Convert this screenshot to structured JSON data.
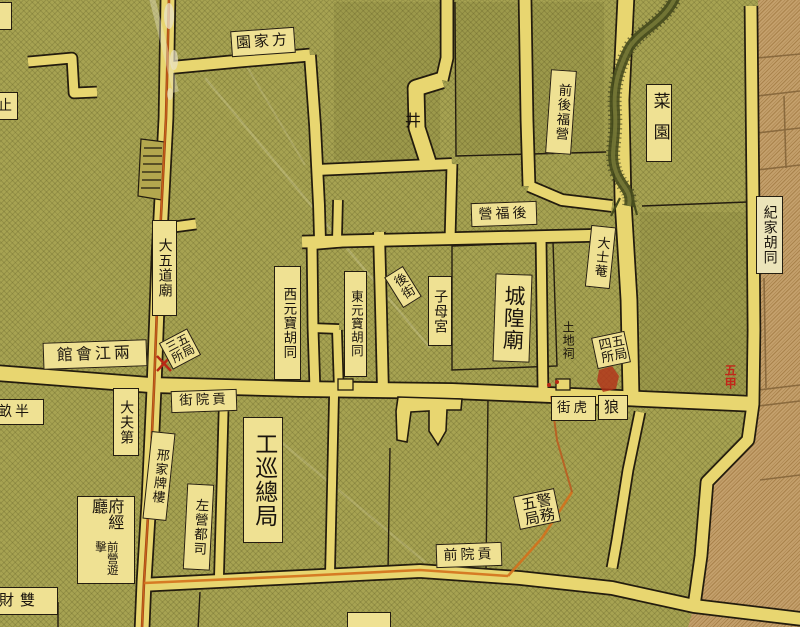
{
  "map": {
    "kind": "historical-chinese-city-map",
    "colors": {
      "field_green": "#a7a352",
      "district_tan": "#c4a06c",
      "road_yellow": "#e8d670",
      "label_bg": "#efe193",
      "ink": "#241d10",
      "route_red": "#9c3a12",
      "route_orange": "#d4711c",
      "mark_red": "#b82815"
    },
    "labels": {
      "fangjiayuan": "方家園",
      "well": "井",
      "qianhou_fuying": "前後福營",
      "hou_fuying": "後福營",
      "caiyuan": "菜園",
      "jijia_hutong": "紀家胡同",
      "dashi_an": "大士菴",
      "dawudao_miao": "大五道廟",
      "xi_yuanbao_hutong": "西元寶胡同",
      "dong_yuanbao_hutong": "東元寶胡同",
      "hou_jie": "後街",
      "zimu_gong": "子母宮",
      "chenghuang_miao": "城隍廟",
      "tudi_ci": "土地祠",
      "wuju_sisuo": "五局四所",
      "wuju_sansuo": "五局三所",
      "liangjiang_huiguan": "兩江會館",
      "banmu": "半畝",
      "dafu_di": "大夫第",
      "gongyuan_jie": "貢院街",
      "xingjia_pailou": "邢家牌樓",
      "gongxun_zongju": "工巡總局",
      "zuoying_dusi": "左營都司",
      "fujing_ting": "府經廳",
      "qianying_youji": "前營遊擊",
      "shuangcai": "雙財",
      "lang": "狼",
      "hu_jie": "虎街",
      "jingwu_wuju": "警務五局",
      "gongyuan_qian": "貢院前",
      "zhi": "止",
      "wujia_red": "五甲"
    },
    "features": {
      "stream": "winding-stream",
      "route_line": "red-orange-surveyed-route",
      "tan_district": "adjacent-district-block"
    }
  }
}
